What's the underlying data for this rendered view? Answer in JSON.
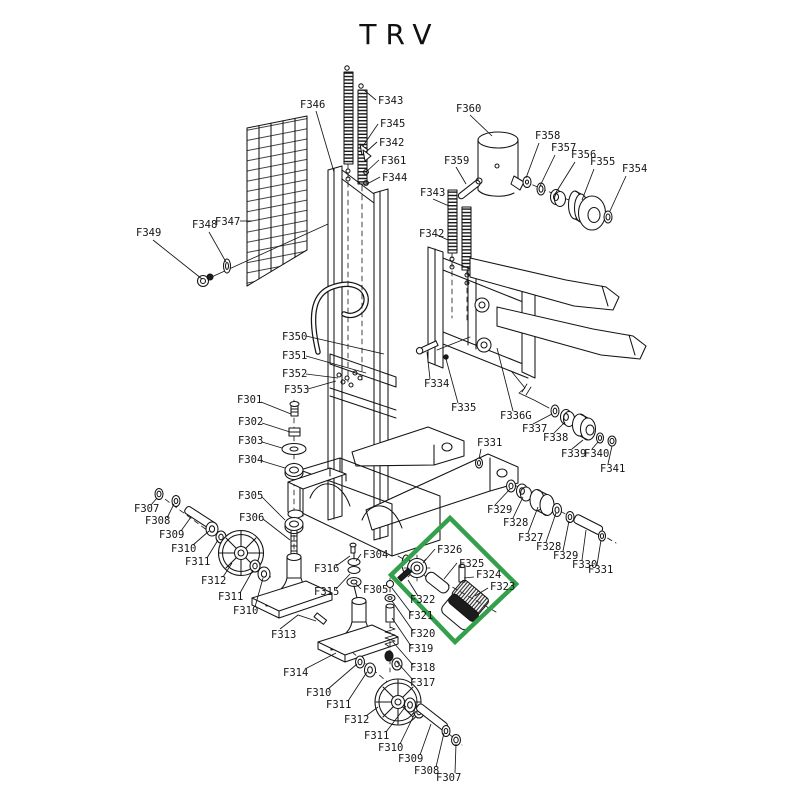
{
  "title": "TRV",
  "highlight": {
    "color": "#35a04c",
    "points": "450,518 516,584 455,642 391,575"
  },
  "labels": [
    {
      "t": "F346",
      "x": 300,
      "y": 108,
      "l": "316,111 334,172"
    },
    {
      "t": "F343",
      "x": 378,
      "y": 104,
      "l": "376,100 364,90"
    },
    {
      "t": "F345",
      "x": 380,
      "y": 127,
      "l": "378,124 363,146"
    },
    {
      "t": "F342",
      "x": 379,
      "y": 146,
      "l": "377,142 366,152"
    },
    {
      "t": "F361",
      "x": 381,
      "y": 164,
      "l": "379,160 366,172"
    },
    {
      "t": "F344",
      "x": 382,
      "y": 181,
      "l": "380,177 367,184"
    },
    {
      "t": "F360",
      "x": 456,
      "y": 112,
      "l": "470,115 492,136"
    },
    {
      "t": "F359",
      "x": 444,
      "y": 164,
      "l": "456,167 466,184"
    },
    {
      "t": "F343",
      "x": 420,
      "y": 196,
      "l": "433,199 449,206"
    },
    {
      "t": "F342",
      "x": 419,
      "y": 237,
      "l": "437,235 448,240"
    },
    {
      "t": "F358",
      "x": 535,
      "y": 139,
      "l": "539,143 526,178"
    },
    {
      "t": "F357",
      "x": 551,
      "y": 151,
      "l": "555,155 540,186"
    },
    {
      "t": "F356",
      "x": 571,
      "y": 158,
      "l": "575,162 555,194"
    },
    {
      "t": "F355",
      "x": 590,
      "y": 165,
      "l": "594,169 582,200"
    },
    {
      "t": "F354",
      "x": 622,
      "y": 172,
      "l": "626,176 610,211"
    },
    {
      "t": "F349",
      "x": 136,
      "y": 236,
      "l": "153,240 202,279"
    },
    {
      "t": "F348",
      "x": 192,
      "y": 228,
      "l": "209,232 226,262"
    },
    {
      "t": "F347",
      "x": 215,
      "y": 225,
      "l": "240,221 252,221"
    },
    {
      "t": "F350",
      "x": 282,
      "y": 340,
      "l": "306,336 384,354"
    },
    {
      "t": "F351",
      "x": 282,
      "y": 359,
      "l": "306,356 366,373"
    },
    {
      "t": "F352",
      "x": 282,
      "y": 377,
      "l": "306,374 338,378"
    },
    {
      "t": "F353",
      "x": 284,
      "y": 393,
      "l": "308,389 336,381"
    },
    {
      "t": "F301",
      "x": 237,
      "y": 403,
      "l": "261,402 291,414"
    },
    {
      "t": "F302",
      "x": 238,
      "y": 425,
      "l": "262,423 290,432"
    },
    {
      "t": "F303",
      "x": 238,
      "y": 444,
      "l": "262,442 282,448"
    },
    {
      "t": "F304",
      "x": 238,
      "y": 463,
      "l": "262,461 285,468"
    },
    {
      "t": "F305",
      "x": 238,
      "y": 499,
      "l": "262,497 285,520"
    },
    {
      "t": "F306",
      "x": 239,
      "y": 521,
      "l": "263,519 290,540"
    },
    {
      "t": "F307",
      "x": 134,
      "y": 512,
      "l": "151,505 157,498"
    },
    {
      "t": "F308",
      "x": 145,
      "y": 524,
      "l": "167,518 174,504"
    },
    {
      "t": "F309",
      "x": 159,
      "y": 538,
      "l": "181,531 191,517"
    },
    {
      "t": "F310",
      "x": 171,
      "y": 552,
      "l": "193,545 209,531"
    },
    {
      "t": "F311",
      "x": 185,
      "y": 565,
      "l": "207,558 218,540"
    },
    {
      "t": "F312",
      "x": 201,
      "y": 584,
      "l": "223,577 232,563"
    },
    {
      "t": "F311",
      "x": 218,
      "y": 600,
      "l": "240,593 253,570"
    },
    {
      "t": "F310",
      "x": 233,
      "y": 614,
      "l": "255,607 263,578"
    },
    {
      "t": "F313",
      "x": 271,
      "y": 638,
      "l": "280,629 298,615 316,621"
    },
    {
      "t": "F314",
      "x": 283,
      "y": 676,
      "l": "305,669 336,653"
    },
    {
      "t": "F316",
      "x": 314,
      "y": 572,
      "l": "336,566 350,556"
    },
    {
      "t": "F315",
      "x": 314,
      "y": 595,
      "l": "336,589 350,574"
    },
    {
      "t": "F304",
      "x": 363,
      "y": 558,
      "l": "361,554 356,561"
    },
    {
      "t": "F305",
      "x": 363,
      "y": 593,
      "l": "361,589 356,584"
    },
    {
      "t": "F322",
      "x": 410,
      "y": 603,
      "l": "418,596 408,580"
    },
    {
      "t": "F321",
      "x": 408,
      "y": 619,
      "l": "411,613 392,588"
    },
    {
      "t": "F320",
      "x": 410,
      "y": 637,
      "l": "413,631 392,601"
    },
    {
      "t": "F319",
      "x": 408,
      "y": 652,
      "l": "411,646 392,618"
    },
    {
      "t": "F318",
      "x": 410,
      "y": 671,
      "l": "413,665 393,642"
    },
    {
      "t": "F317",
      "x": 410,
      "y": 686,
      "l": "413,680 397,662"
    },
    {
      "t": "F326",
      "x": 437,
      "y": 553,
      "l": "435,549 423,563"
    },
    {
      "t": "F325",
      "x": 459,
      "y": 567,
      "l": "457,563 444,579"
    },
    {
      "t": "F324",
      "x": 476,
      "y": 578,
      "l": "474,577 464,578"
    },
    {
      "t": "F323",
      "x": 490,
      "y": 590,
      "l": "488,588 475,596"
    },
    {
      "t": "F334",
      "x": 424,
      "y": 387,
      "l": "430,379 427,352"
    },
    {
      "t": "F335",
      "x": 451,
      "y": 411,
      "l": "458,403 446,359"
    },
    {
      "t": "F336G",
      "x": 500,
      "y": 419,
      "l": "513,411 497,348"
    },
    {
      "t": "F337",
      "x": 522,
      "y": 432,
      "l": "533,424 552,414"
    },
    {
      "t": "F338",
      "x": 543,
      "y": 441,
      "l": "554,433 565,422"
    },
    {
      "t": "F339",
      "x": 561,
      "y": 457,
      "l": "572,449 583,440"
    },
    {
      "t": "F340",
      "x": 584,
      "y": 457,
      "l": "592,449 598,442"
    },
    {
      "t": "F341",
      "x": 600,
      "y": 472,
      "l": "608,464 612,446"
    },
    {
      "t": "F331",
      "x": 477,
      "y": 446,
      "l": "481,449 479,459"
    },
    {
      "t": "F329",
      "x": 487,
      "y": 513,
      "l": "495,505 510,489"
    },
    {
      "t": "F328",
      "x": 503,
      "y": 526,
      "l": "513,518 523,497"
    },
    {
      "t": "F327",
      "x": 518,
      "y": 541,
      "l": "528,533 538,507"
    },
    {
      "t": "F328",
      "x": 536,
      "y": 550,
      "l": "546,542 556,513"
    },
    {
      "t": "F329",
      "x": 553,
      "y": 559,
      "l": "563,551 569,521"
    },
    {
      "t": "F330",
      "x": 572,
      "y": 568,
      "l": "582,560 586,530"
    },
    {
      "t": "F331",
      "x": 588,
      "y": 573,
      "l": "597,565 601,540"
    },
    {
      "t": "F310",
      "x": 306,
      "y": 696,
      "l": "328,689 357,664"
    },
    {
      "t": "F311",
      "x": 326,
      "y": 708,
      "l": "348,701 367,672"
    },
    {
      "t": "F312",
      "x": 344,
      "y": 723,
      "l": "366,716 378,707"
    },
    {
      "t": "F311",
      "x": 364,
      "y": 739,
      "l": "386,732 406,706"
    },
    {
      "t": "F310",
      "x": 378,
      "y": 751,
      "l": "400,744 416,711"
    },
    {
      "t": "F309",
      "x": 398,
      "y": 762,
      "l": "420,755 431,724"
    },
    {
      "t": "F308",
      "x": 414,
      "y": 774,
      "l": "436,767 444,733"
    },
    {
      "t": "F307",
      "x": 436,
      "y": 781,
      "l": "455,773 456,744"
    }
  ]
}
